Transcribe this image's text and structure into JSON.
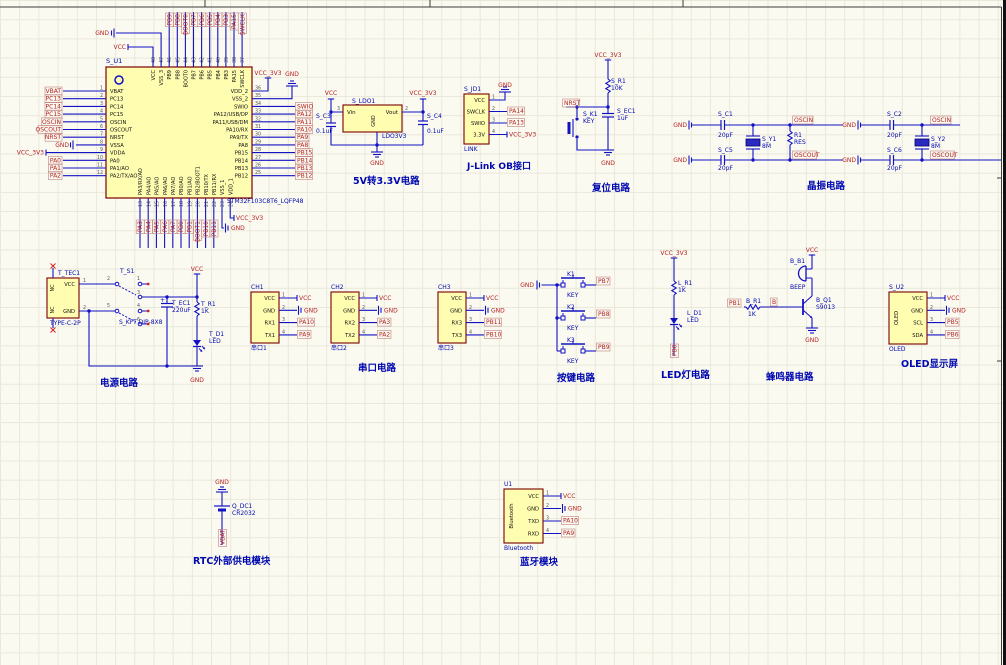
{
  "colors": {
    "background": "#FBFAF1",
    "grid": "#E9E8DA",
    "wire": "#1212C4",
    "power_label": "#A02020",
    "net_label": "#B42222",
    "net_box": "#C08080",
    "component_fill": "#FFFDB0",
    "component_border": "#7A0000",
    "designator": "#0008B0",
    "title": "#0008B0",
    "pin_number": "#555555",
    "pin_name": "#111111",
    "sheet_border": "#3C3C3C",
    "no_connect": "#D02020",
    "window_edge": "#111111"
  },
  "mcu": {
    "designator": "S_U1",
    "part": "STM32F103C8T6_LQFP48",
    "left_pins": [
      {
        "num": "1",
        "name": "VBAT",
        "net": "VBAT"
      },
      {
        "num": "2",
        "name": "PC13",
        "net": "PC13"
      },
      {
        "num": "3",
        "name": "PC14",
        "net": "PC14"
      },
      {
        "num": "4",
        "name": "PC15",
        "net": "PC15"
      },
      {
        "num": "5",
        "name": "OSCIN",
        "net": "OSCIN"
      },
      {
        "num": "6",
        "name": "OSCOUT",
        "net": "OSCOUT"
      },
      {
        "num": "7",
        "name": "NRST",
        "net": "NRST"
      },
      {
        "num": "8",
        "name": "VSSA",
        "net": "GND"
      },
      {
        "num": "9",
        "name": "VDDA",
        "net": "VCC_3V3"
      },
      {
        "num": "10",
        "name": "PA0",
        "net": "PA0"
      },
      {
        "num": "11",
        "name": "PA1/AO",
        "net": "PA1"
      },
      {
        "num": "12",
        "name": "PA2/TX/AO",
        "net": "PA2"
      }
    ],
    "right_pins": [
      {
        "num": "36",
        "name": "VDD_2",
        "net": "VCC_3V3"
      },
      {
        "num": "35",
        "name": "VSS_2",
        "net": "GND"
      },
      {
        "num": "34",
        "name": "SWIO",
        "net": "SWIO"
      },
      {
        "num": "33",
        "name": "PA12/USB/DP",
        "net": "PA12"
      },
      {
        "num": "32",
        "name": "PA11/USB/DM",
        "net": "PA11"
      },
      {
        "num": "31",
        "name": "PA10/RX",
        "net": "PA10"
      },
      {
        "num": "30",
        "name": "PA9/TX",
        "net": "PA9"
      },
      {
        "num": "29",
        "name": "PA8",
        "net": "PA8"
      },
      {
        "num": "28",
        "name": "PB15",
        "net": "PB15"
      },
      {
        "num": "27",
        "name": "PB14",
        "net": "PB14"
      },
      {
        "num": "26",
        "name": "PB13",
        "net": "PB13"
      },
      {
        "num": "25",
        "name": "PB12",
        "net": "PB12"
      }
    ],
    "top_pins": [
      {
        "num": "48",
        "name": "VCC",
        "net": "VCC"
      },
      {
        "num": "47",
        "name": "VSS_3",
        "net": "GND"
      },
      {
        "num": "46",
        "name": "PB9",
        "net": "PB9"
      },
      {
        "num": "45",
        "name": "PB8",
        "net": "PB8"
      },
      {
        "num": "44",
        "name": "BOOT0",
        "net": "BOOT0"
      },
      {
        "num": "43",
        "name": "PB7",
        "net": "PB7"
      },
      {
        "num": "42",
        "name": "PB6",
        "net": "PB6"
      },
      {
        "num": "41",
        "name": "PB5",
        "net": "PB5"
      },
      {
        "num": "40",
        "name": "PB4",
        "net": "PB4"
      },
      {
        "num": "39",
        "name": "PB3",
        "net": "PB3"
      },
      {
        "num": "38",
        "name": "PA15",
        "net": "PA15"
      },
      {
        "num": "37",
        "name": "SWCLK",
        "net": "SWCLK"
      }
    ],
    "bottom_pins": [
      {
        "num": "13",
        "name": "PA3/RX/AO",
        "net": "PA3"
      },
      {
        "num": "14",
        "name": "PA4/AO",
        "net": "PA4"
      },
      {
        "num": "15",
        "name": "PA5/AO",
        "net": "PA5"
      },
      {
        "num": "16",
        "name": "PA6/AO",
        "net": "PA6"
      },
      {
        "num": "17",
        "name": "PA7/AO",
        "net": "PA7"
      },
      {
        "num": "18",
        "name": "PB0/AO",
        "net": "PB0"
      },
      {
        "num": "19",
        "name": "PB1/AO",
        "net": "PB1"
      },
      {
        "num": "20",
        "name": "PB2/BOOT1",
        "net": "BOOT1"
      },
      {
        "num": "21",
        "name": "PB10/TX",
        "net": "PB10"
      },
      {
        "num": "22",
        "name": "PB11/RX",
        "net": "PB11"
      },
      {
        "num": "23",
        "name": "VSS_1",
        "net": "GND"
      },
      {
        "num": "24",
        "name": "VDD_1",
        "net": "VCC_3V3"
      }
    ]
  },
  "ldo": {
    "designator": "S_LDO1",
    "part": "LDO3V3",
    "title": "5V转3.3V电路",
    "pin_in": {
      "num": "3",
      "name": "Vin"
    },
    "pin_out": {
      "num": "2",
      "name": "Vout"
    },
    "pin_gnd": {
      "name": "GND"
    },
    "cap_in": {
      "designator": "S_C3",
      "value": "0.1uF"
    },
    "cap_out": {
      "designator": "S_C4",
      "value": "0.1uF"
    },
    "net_in": "VCC",
    "net_out": "VCC_3V3",
    "net_gnd": "GND"
  },
  "jlink": {
    "designator": "S_JD1",
    "part": "LINK",
    "title": "J-Link OB接口",
    "pins": [
      {
        "num": "1",
        "name": "VCC",
        "net": "GND"
      },
      {
        "num": "2",
        "name": "SWCLK",
        "net": "PA14"
      },
      {
        "num": "3",
        "name": "SWIO",
        "net": "PA13"
      },
      {
        "num": "4",
        "name": "3.3V",
        "net": "VCC_3V3"
      }
    ]
  },
  "reset": {
    "title": "复位电路",
    "net_top": "VCC_3V3",
    "net_left": "NRST",
    "net_gnd": "GND",
    "resistor": {
      "designator": "S_R1",
      "value": "10K"
    },
    "button": {
      "designator": "S_K1",
      "value": "KEY"
    },
    "cap": {
      "designator": "S_EC1",
      "value": "1uF"
    }
  },
  "crystals": {
    "title": "晶振电路",
    "groups": [
      {
        "gnd": "GND",
        "cap_top": {
          "designator": "S_C1",
          "value": "20pF"
        },
        "cap_bot": {
          "designator": "S_C5",
          "value": "20pF"
        },
        "xtal": {
          "designator": "S_Y1",
          "value": "8M"
        },
        "res": {
          "designator": "R1",
          "value": "RES"
        },
        "net_top": "OSCIN",
        "net_bot": "OSCOUT"
      },
      {
        "gnd": "GND",
        "cap_top": {
          "designator": "S_C2",
          "value": "20pF"
        },
        "cap_bot": {
          "designator": "S_C6",
          "value": "20pF"
        },
        "xtal": {
          "designator": "S_Y2",
          "value": "8M"
        },
        "net_top": "OSCIN",
        "net_bot": "OSCOUT"
      }
    ]
  },
  "power": {
    "title": "电源电路",
    "net_vcc": "VCC",
    "net_gnd": "GND",
    "connector": {
      "designator": "T_TEC1",
      "part": "TYPE-C-2P",
      "nc": "NC",
      "pins": [
        {
          "num": "1",
          "name": "VCC"
        },
        {
          "num": "2",
          "name": "GND"
        }
      ]
    },
    "switch": {
      "designator": "T_S1",
      "part": "S_KFT DIP-8X8",
      "pin_numbers": [
        "1",
        "2",
        "3",
        "4",
        "5",
        "6"
      ]
    },
    "cap": {
      "designator": "T_EC1",
      "value": "220uF"
    },
    "resistor": {
      "designator": "T_R1",
      "value": "1K"
    },
    "led": {
      "designator": "T_D1",
      "value": "LED"
    }
  },
  "serial": {
    "title": "串口电路",
    "ports": [
      {
        "designator": "CH1",
        "part": "串口1",
        "pins": [
          {
            "num": "1",
            "name": "VCC",
            "net": "VCC"
          },
          {
            "num": "2",
            "name": "GND",
            "net": "GND"
          },
          {
            "num": "3",
            "name": "RX1",
            "net": "PA10"
          },
          {
            "num": "4",
            "name": "TX1",
            "net": "PA9"
          }
        ]
      },
      {
        "designator": "CH2",
        "part": "串口2",
        "pins": [
          {
            "num": "1",
            "name": "VCC",
            "net": "VCC"
          },
          {
            "num": "2",
            "name": "GND",
            "net": "GND"
          },
          {
            "num": "3",
            "name": "RX2",
            "net": "PA3"
          },
          {
            "num": "4",
            "name": "TX2",
            "net": "PA2"
          }
        ]
      },
      {
        "designator": "CH3",
        "part": "串口3",
        "pins": [
          {
            "num": "1",
            "name": "VCC",
            "net": "VCC"
          },
          {
            "num": "2",
            "name": "GND",
            "net": "GND"
          },
          {
            "num": "3",
            "name": "RX3",
            "net": "PB11"
          },
          {
            "num": "4",
            "name": "TX3",
            "net": "PB10"
          }
        ]
      }
    ]
  },
  "keys": {
    "title": "按键电路",
    "gnd": "GND",
    "buttons": [
      {
        "designator": "K1",
        "value": "KEY",
        "net": "PB7"
      },
      {
        "designator": "K2",
        "value": "KEY",
        "net": "PB8"
      },
      {
        "designator": "K3",
        "value": "KEY",
        "net": "PB9"
      }
    ]
  },
  "led": {
    "title": "LED灯电路",
    "net_top": "VCC_3V3",
    "net_bottom": "PB0",
    "resistor": {
      "designator": "L_R1",
      "value": "1K"
    },
    "led": {
      "designator": "L_D1",
      "value": "LED"
    }
  },
  "buzzer": {
    "title": "蜂鸣器电路",
    "net_top": "VCC",
    "net_gnd": "GND",
    "net_in": "PB1",
    "net_base": "B",
    "buzzer": {
      "designator": "B_B1",
      "value": "BEEP"
    },
    "resistor": {
      "designator": "B_R1",
      "value": "1K"
    },
    "transistor": {
      "designator": "B_Q1",
      "value": "S9013"
    }
  },
  "oled": {
    "designator": "S_U2",
    "part": "OLED",
    "side_text": "OLED",
    "title": "OLED显示屏",
    "pins": [
      {
        "num": "1",
        "name": "VCC",
        "net": "VCC"
      },
      {
        "num": "2",
        "name": "GND",
        "net": "GND"
      },
      {
        "num": "3",
        "name": "SCL",
        "net": "PB5"
      },
      {
        "num": "4",
        "name": "SDA",
        "net": "PB6"
      }
    ]
  },
  "rtc": {
    "title": "RTC外部供电模块",
    "net_top": "GND",
    "net_bottom": "VBAT",
    "battery": {
      "designator": "Q_DC1",
      "value": "CR2032"
    }
  },
  "bluetooth": {
    "designator": "U1",
    "part": "Bluetooth",
    "side_text": "Bluetooth",
    "title": "蓝牙模块",
    "pins": [
      {
        "num": "1",
        "name": "VCC",
        "net": "VCC"
      },
      {
        "num": "2",
        "name": "GND",
        "net": "GND"
      },
      {
        "num": "3",
        "name": "TXD",
        "net": "PA10"
      },
      {
        "num": "4",
        "name": "RXD",
        "net": "PA9"
      }
    ]
  }
}
